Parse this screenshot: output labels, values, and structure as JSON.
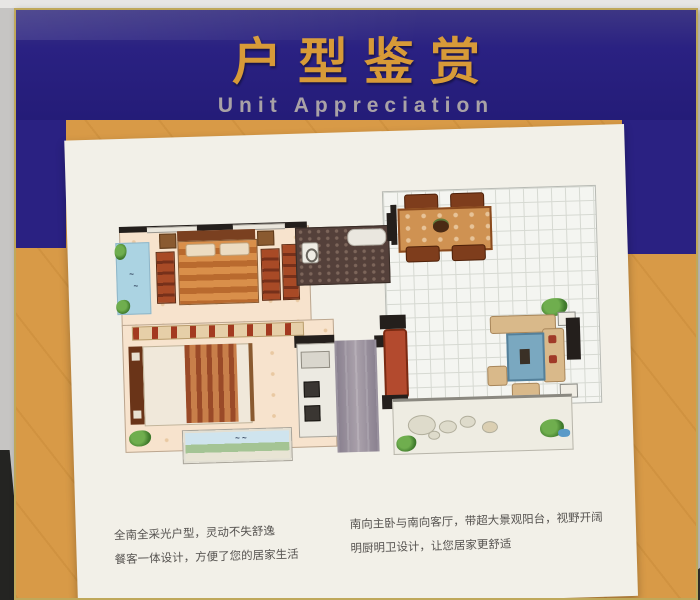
{
  "header": {
    "title": "户型鉴赏",
    "subtitle": "Unit Appreciation"
  },
  "descriptions": {
    "left_line1": "全南全采光户型，灵动不失舒逸",
    "left_line2": "餐客一体设计，方便了您的居家生活",
    "right_line1": "南向主卧与南向客厅，带超大景观阳台，视野开阔",
    "right_line2": "明厨明卫设计，让您居家更舒适"
  },
  "colors": {
    "header_blue": "#2a2182",
    "title_gold": "#d79a38",
    "subtitle_gray": "#a9a2a6",
    "panel_orange": "#d89a47",
    "frame_gold": "#bfa85a",
    "card_white": "#f2f0e8",
    "balcony_blue": "#abd3e2",
    "bathroom_dark": "#54403a"
  }
}
